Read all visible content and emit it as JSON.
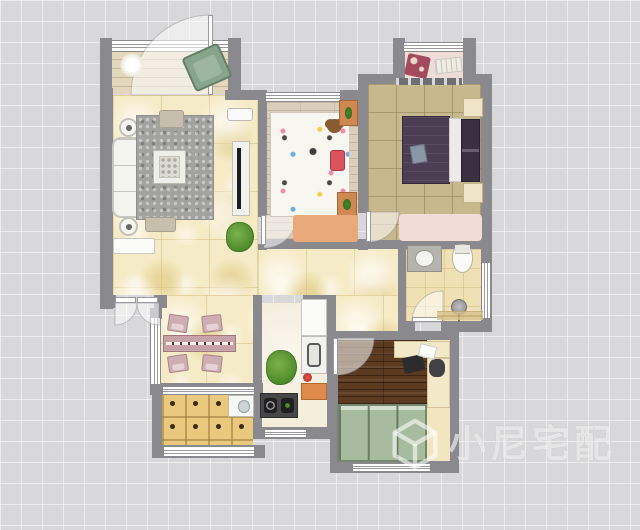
{
  "watermark": {
    "text": "小尼宅配",
    "logo": "cube-logo",
    "color": "rgba(255,255,255,0.6)"
  },
  "palette": {
    "exterior_bg": "#d8d8da",
    "wall": "#8a8a8e",
    "tile_yellow": "#f5ebc6",
    "wood_light": "#d9cfba",
    "khaki": "#c7b98e",
    "wood_dark": "#5b3a20",
    "grid_wood": "#eac87e",
    "wardrobe_green": "#a7bc9f",
    "bed_purple": "#4b3d52",
    "accent_orange": "#e08b4e",
    "rug_gray": "#a2a2a0",
    "rug_pink": "#f1ddd7"
  },
  "plan": {
    "width": 640,
    "height": 530,
    "floors": [
      {
        "name": "balcony-top-floor",
        "tex": "plank-beige",
        "x": 112,
        "y": 50,
        "w": 116,
        "h": 44
      },
      {
        "name": "living-room-floor",
        "tex": "tile-yellow",
        "x": 113,
        "y": 95,
        "w": 145,
        "h": 200
      },
      {
        "name": "dining-area-floor",
        "tex": "tile-yellow",
        "x": 158,
        "y": 295,
        "w": 95,
        "h": 90
      },
      {
        "name": "hallway-floor",
        "tex": "tile-yellow",
        "x": 258,
        "y": 248,
        "w": 140,
        "h": 47
      },
      {
        "name": "hallway-floor-2",
        "tex": "tile-yellow",
        "x": 335,
        "y": 295,
        "w": 63,
        "h": 37
      },
      {
        "name": "kids-bedroom-floor",
        "tex": "wood-light",
        "x": 266,
        "y": 102,
        "w": 92,
        "h": 137
      },
      {
        "name": "master-bedroom-floor",
        "tex": "khaki",
        "x": 368,
        "y": 84,
        "w": 113,
        "h": 157
      },
      {
        "name": "bay-window-floor",
        "tex": "pink",
        "x": 405,
        "y": 52,
        "w": 58,
        "h": 29
      },
      {
        "name": "bathroom-floor",
        "tex": "cream-tile",
        "x": 406,
        "y": 249,
        "w": 75,
        "h": 73
      },
      {
        "name": "kitchen-floor",
        "tex": "kitchen",
        "x": 262,
        "y": 303,
        "w": 65,
        "h": 125
      },
      {
        "name": "study-floor-base",
        "tex": "cream",
        "x": 337,
        "y": 340,
        "w": 113,
        "h": 121
      },
      {
        "name": "study-wood-floor",
        "tex": "wood-dark",
        "x": 337,
        "y": 340,
        "w": 90,
        "h": 64
      },
      {
        "name": "laundry-balcony-floor",
        "tex": "grid-wood",
        "x": 162,
        "y": 393,
        "w": 91,
        "h": 53
      }
    ],
    "walls": [
      [
        100,
        38,
        12,
        57
      ],
      [
        228,
        38,
        13,
        57
      ],
      [
        100,
        88,
        13,
        221
      ],
      [
        225,
        90,
        42,
        10
      ],
      [
        258,
        95,
        9,
        122
      ],
      [
        258,
        244,
        9,
        6
      ],
      [
        266,
        239,
        101,
        10
      ],
      [
        340,
        90,
        27,
        10
      ],
      [
        358,
        74,
        10,
        31
      ],
      [
        362,
        74,
        34,
        10
      ],
      [
        393,
        38,
        12,
        46
      ],
      [
        463,
        38,
        13,
        46
      ],
      [
        473,
        74,
        19,
        10
      ],
      [
        481,
        74,
        11,
        252
      ],
      [
        358,
        95,
        10,
        118
      ],
      [
        358,
        241,
        10,
        9
      ],
      [
        366,
        240,
        126,
        9
      ],
      [
        398,
        249,
        8,
        74
      ],
      [
        398,
        321,
        17,
        11
      ],
      [
        441,
        321,
        51,
        11
      ],
      [
        253,
        295,
        9,
        144
      ],
      [
        303,
        295,
        33,
        9
      ],
      [
        327,
        295,
        9,
        144
      ],
      [
        255,
        427,
        81,
        12
      ],
      [
        100,
        295,
        16,
        13
      ],
      [
        154,
        295,
        13,
        13
      ],
      [
        150,
        308,
        12,
        11
      ],
      [
        150,
        383,
        12,
        12
      ],
      [
        160,
        383,
        103,
        10
      ],
      [
        152,
        390,
        10,
        67
      ],
      [
        152,
        445,
        113,
        13
      ],
      [
        335,
        331,
        124,
        9
      ],
      [
        330,
        331,
        8,
        141
      ],
      [
        330,
        461,
        129,
        12
      ],
      [
        450,
        331,
        9,
        142
      ]
    ],
    "windows": [
      {
        "name": "balcony-window",
        "o": "h",
        "x": 111,
        "y": 40,
        "w": 118,
        "h": 12
      },
      {
        "name": "bay-window",
        "o": "h",
        "x": 403,
        "y": 42,
        "w": 61,
        "h": 10
      },
      {
        "name": "kids-room-window",
        "o": "h",
        "x": 265,
        "y": 92,
        "w": 76,
        "h": 10
      },
      {
        "name": "dining-west-window",
        "o": "v",
        "x": 150,
        "y": 317,
        "w": 11,
        "h": 68
      },
      {
        "name": "balcony-slider",
        "o": "h",
        "x": 162,
        "y": 386,
        "w": 93,
        "h": 9
      },
      {
        "name": "laundry-window",
        "o": "h",
        "x": 163,
        "y": 446,
        "w": 92,
        "h": 11
      },
      {
        "name": "kitchen-window",
        "o": "h",
        "x": 264,
        "y": 429,
        "w": 43,
        "h": 9
      },
      {
        "name": "study-window",
        "o": "h",
        "x": 352,
        "y": 463,
        "w": 79,
        "h": 9
      },
      {
        "name": "bathroom-window",
        "o": "v",
        "x": 481,
        "y": 262,
        "w": 10,
        "h": 57
      }
    ],
    "door_leaves": [
      [
        208,
        15,
        5,
        80
      ],
      [
        115,
        297,
        21,
        6
      ],
      [
        137,
        297,
        21,
        6
      ],
      [
        261,
        215,
        5,
        30
      ],
      [
        366,
        211,
        5,
        31
      ],
      [
        412,
        317,
        31,
        5
      ],
      [
        333,
        338,
        5,
        37
      ]
    ],
    "door_arcs": [
      "M211,95 L211,15 A80,80 0 0 0 131,95 Z",
      "M115,303 L137,303 A22,22 0 0 1 115,325 Z",
      "M159,303 L137,303 A22,22 0 0 0 159,325 Z",
      "M264,215 L264,248 A33,33 0 0 0 297,215 Z",
      "M369,212 L369,242 A30,30 0 0 0 399,212 Z",
      "M443,322 L412,322 A31,31 0 0 1 443,291 Z",
      "M337,338 L337,375 A37,37 0 0 0 374,338 Z"
    ],
    "furniture": [
      {
        "name": "ceiling-light",
        "kind": "ceiling-light",
        "x": 120,
        "y": 53,
        "w": 24,
        "h": 24
      },
      {
        "name": "balcony-armchair",
        "kind": "armchair-green",
        "x": 187,
        "y": 49,
        "w": 40,
        "h": 37,
        "rot": -24
      },
      {
        "name": "shoe-cabinet",
        "kind": "shoe-cabinet",
        "x": 113,
        "y": 238,
        "w": 42,
        "h": 16
      },
      {
        "name": "sofa",
        "kind": "sofa",
        "x": 112,
        "y": 137,
        "w": 34,
        "h": 81
      },
      {
        "name": "side-table-top",
        "kind": "round-table",
        "x": 119,
        "y": 118,
        "w": 19,
        "h": 19
      },
      {
        "name": "side-table-bottom",
        "kind": "round-table",
        "x": 119,
        "y": 217,
        "w": 19,
        "h": 19
      },
      {
        "name": "living-rug",
        "kind": "rug-gray",
        "x": 136,
        "y": 115,
        "w": 78,
        "h": 105
      },
      {
        "name": "coffee-table",
        "kind": "coffee-table",
        "x": 153,
        "y": 150,
        "w": 33,
        "h": 34
      },
      {
        "name": "ottoman-top",
        "kind": "ottoman",
        "x": 159,
        "y": 110,
        "w": 25,
        "h": 18
      },
      {
        "name": "ottoman-bottom",
        "kind": "ottoman",
        "x": 145,
        "y": 217,
        "w": 31,
        "h": 15
      },
      {
        "name": "tv-cabinet",
        "kind": "tv-bench",
        "x": 232,
        "y": 141,
        "w": 18,
        "h": 75
      },
      {
        "name": "ac-unit",
        "kind": "ac-unit",
        "x": 227,
        "y": 108,
        "w": 26,
        "h": 13
      },
      {
        "name": "living-plant",
        "kind": "plant",
        "x": 226,
        "y": 222,
        "w": 28,
        "h": 30
      },
      {
        "name": "dining-table",
        "kind": "dining-table",
        "x": 163,
        "y": 335,
        "w": 73,
        "h": 17
      },
      {
        "name": "dining-chair-1",
        "kind": "chair-pink",
        "x": 168,
        "y": 315,
        "w": 20,
        "h": 17,
        "rot": 8
      },
      {
        "name": "dining-chair-2",
        "kind": "chair-pink",
        "x": 202,
        "y": 315,
        "w": 20,
        "h": 17,
        "rot": -6
      },
      {
        "name": "dining-chair-3",
        "kind": "chair-pink",
        "x": 168,
        "y": 355,
        "w": 20,
        "h": 17,
        "rot": -8
      },
      {
        "name": "dining-chair-4",
        "kind": "chair-pink",
        "x": 202,
        "y": 355,
        "w": 20,
        "h": 17,
        "rot": 6
      },
      {
        "name": "dining-plant",
        "kind": "plant",
        "x": 266,
        "y": 350,
        "w": 31,
        "h": 35
      },
      {
        "name": "kids-bed",
        "kind": "bed-kids",
        "x": 270,
        "y": 112,
        "w": 80,
        "h": 105
      },
      {
        "name": "teddy-bear",
        "kind": "teddy",
        "x": 327,
        "y": 119,
        "w": 15,
        "h": 14
      },
      {
        "name": "kids-pillow",
        "kind": "pillow-red",
        "x": 330,
        "y": 150,
        "w": 15,
        "h": 21
      },
      {
        "name": "kids-nightstand-top",
        "kind": "nightstand-orange",
        "x": 339,
        "y": 100,
        "w": 19,
        "h": 26
      },
      {
        "name": "kids-nightstand-bottom",
        "kind": "nightstand-orange",
        "x": 337,
        "y": 192,
        "w": 20,
        "h": 25
      },
      {
        "name": "kids-rug",
        "kind": "rug-orange",
        "x": 293,
        "y": 215,
        "w": 65,
        "h": 27
      },
      {
        "name": "bay-cushion-floral",
        "kind": "cushion-floral",
        "x": 406,
        "y": 55,
        "w": 23,
        "h": 22,
        "rot": 12
      },
      {
        "name": "bay-cushion-white",
        "kind": "cushion-white",
        "x": 435,
        "y": 58,
        "w": 27,
        "h": 15,
        "rot": -6
      },
      {
        "name": "bay-sill",
        "kind": "sill-dark",
        "x": 396,
        "y": 78,
        "w": 66,
        "h": 7
      },
      {
        "name": "master-bed-duvet",
        "kind": "bed-duvet",
        "x": 402,
        "y": 116,
        "w": 48,
        "h": 68
      },
      {
        "name": "master-bed-sheet",
        "kind": "bed-sheet",
        "x": 449,
        "y": 118,
        "w": 13,
        "h": 64
      },
      {
        "name": "master-bed-pillows",
        "kind": "bed-pillows",
        "x": 461,
        "y": 119,
        "w": 19,
        "h": 63
      },
      {
        "name": "master-nightstand-n",
        "kind": "nightstand-cream",
        "x": 463,
        "y": 98,
        "w": 20,
        "h": 19
      },
      {
        "name": "master-nightstand-s",
        "kind": "nightstand-cream",
        "x": 463,
        "y": 183,
        "w": 20,
        "h": 20
      },
      {
        "name": "book-on-bed",
        "kind": "book",
        "x": 411,
        "y": 145,
        "w": 15,
        "h": 18,
        "rot": -10
      },
      {
        "name": "master-rug",
        "kind": "rug-pink",
        "x": 399,
        "y": 214,
        "w": 83,
        "h": 27
      },
      {
        "name": "bathroom-vanity",
        "kind": "vanity",
        "x": 407,
        "y": 245,
        "w": 35,
        "h": 27
      },
      {
        "name": "toilet",
        "kind": "toilet",
        "x": 452,
        "y": 244,
        "w": 21,
        "h": 29
      },
      {
        "name": "shower-head",
        "kind": "shower-head",
        "x": 451,
        "y": 299,
        "w": 16,
        "h": 16
      },
      {
        "name": "shower-tiles",
        "kind": "shower-tiles",
        "x": 437,
        "y": 311,
        "w": 46,
        "h": 9
      },
      {
        "name": "kitchen-cabinet",
        "kind": "cabinet-white",
        "x": 301,
        "y": 299,
        "w": 26,
        "h": 37
      },
      {
        "name": "kitchen-sink",
        "kind": "sink-kitchen",
        "x": 301,
        "y": 336,
        "w": 26,
        "h": 38
      },
      {
        "name": "kettle",
        "kind": "kettle",
        "x": 303,
        "y": 373,
        "w": 9,
        "h": 9
      },
      {
        "name": "kitchen-cabinet-orange",
        "kind": "cabinet-orange",
        "x": 301,
        "y": 383,
        "w": 26,
        "h": 17
      },
      {
        "name": "stove",
        "kind": "stove",
        "x": 260,
        "y": 393,
        "w": 38,
        "h": 25
      },
      {
        "name": "laundry-sink",
        "kind": "washer",
        "x": 228,
        "y": 395,
        "w": 26,
        "h": 22
      },
      {
        "name": "desk-top",
        "kind": "desk",
        "x": 394,
        "y": 341,
        "w": 56,
        "h": 17
      },
      {
        "name": "desk-right",
        "kind": "desk",
        "x": 427,
        "y": 358,
        "w": 23,
        "h": 50
      },
      {
        "name": "laptop",
        "kind": "laptop",
        "x": 403,
        "y": 356,
        "w": 21,
        "h": 16,
        "rot": -12
      },
      {
        "name": "office-chair",
        "kind": "office-chair",
        "x": 429,
        "y": 359,
        "w": 16,
        "h": 18
      },
      {
        "name": "papers",
        "kind": "papers",
        "x": 419,
        "y": 345,
        "w": 17,
        "h": 13,
        "rot": 14
      },
      {
        "name": "wardrobe",
        "kind": "wardrobe",
        "x": 337,
        "y": 404,
        "w": 90,
        "h": 58
      }
    ]
  }
}
